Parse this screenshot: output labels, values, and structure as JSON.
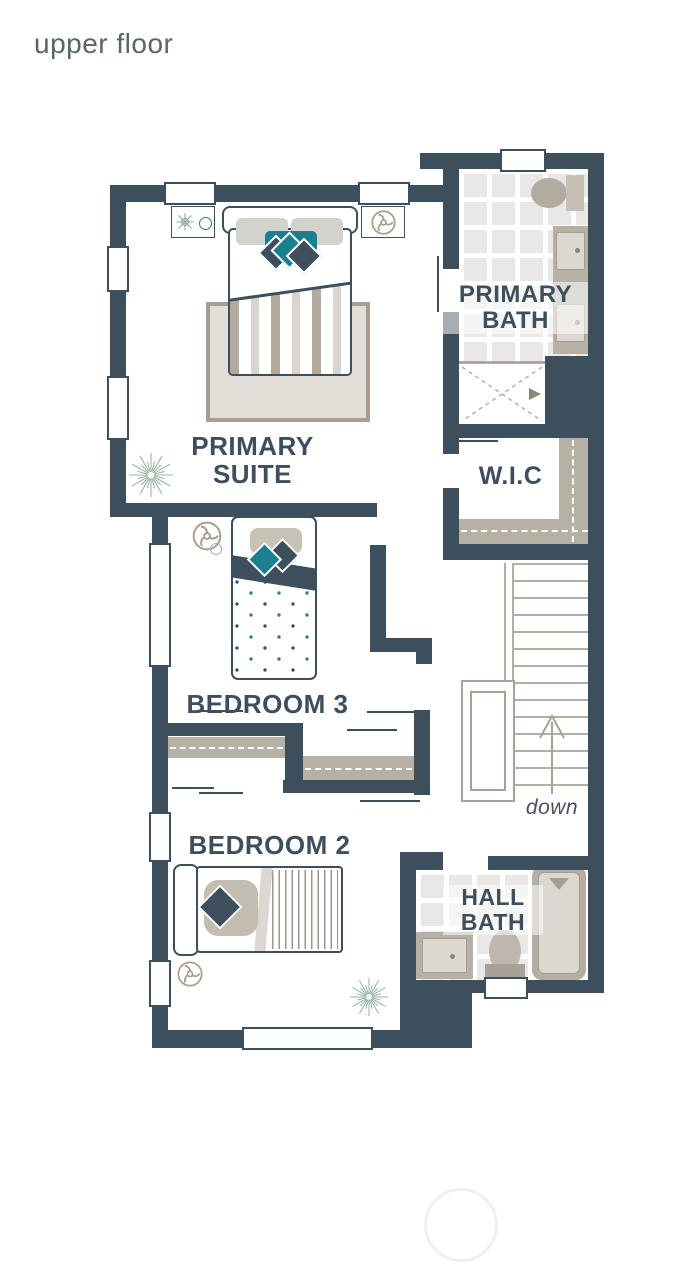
{
  "header": {
    "title": "upper floor"
  },
  "rooms": {
    "primary_suite": {
      "line1": "PRIMARY",
      "line2": "SUITE"
    },
    "primary_bath": {
      "line1": "PRIMARY",
      "line2": "BATH"
    },
    "wic": {
      "label": "W.I.C"
    },
    "bedroom3": {
      "label": "BEDROOM 3"
    },
    "bedroom2": {
      "label": "BEDROOM 2"
    },
    "hall_bath": {
      "line1": "HALL",
      "line2": "BATH"
    }
  },
  "stairs": {
    "direction": "down"
  },
  "colors": {
    "wall": "#3d4e5c",
    "accent_teal": "#1b7f90",
    "furniture_beige": "#b7b1a5",
    "plant_green": "#94b5a4",
    "text": "#3d4e5c"
  }
}
